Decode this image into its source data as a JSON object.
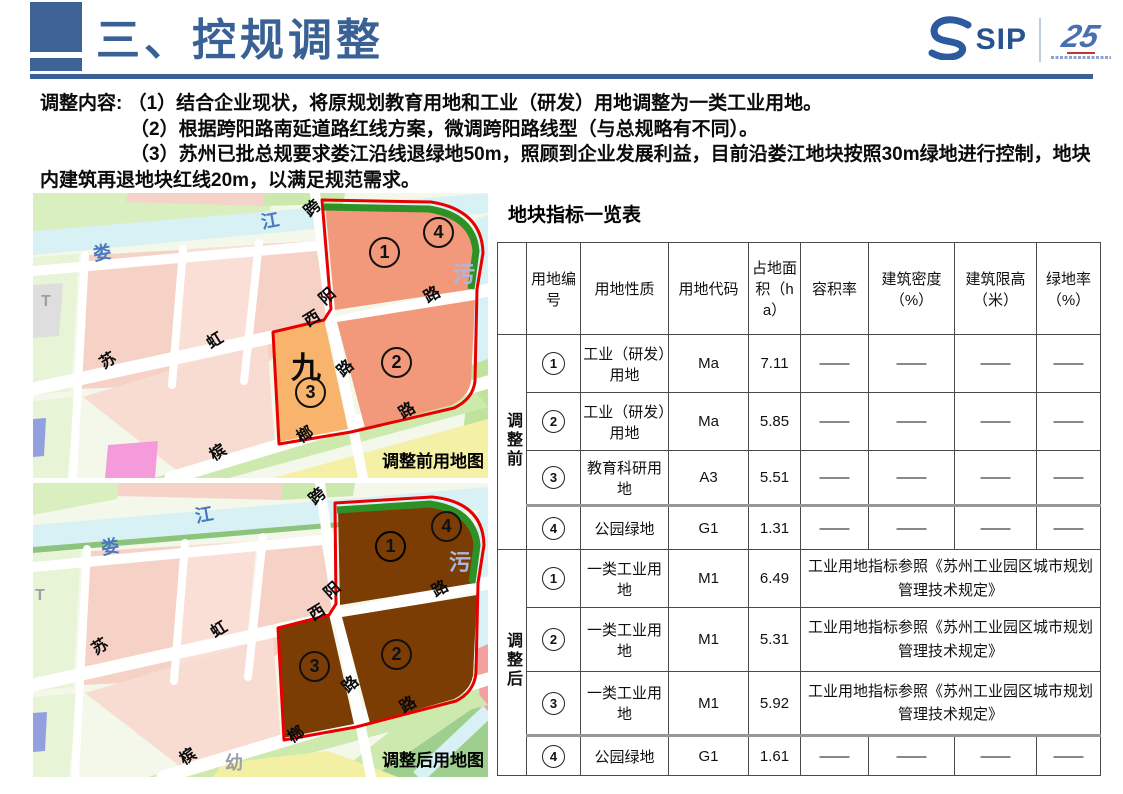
{
  "colors": {
    "accent_blue": "#3A6195",
    "table_red": "#C00000",
    "outline_red": "#E80000",
    "park_green": "#2E9125",
    "industry_rd_salmon": "#F2997B",
    "education_orange": "#F8B46C",
    "industry_m1_brown": "#7C3D05"
  },
  "header": {
    "title": "三、控规调整",
    "logo_sip": "SIP",
    "logo_anniversary": "25"
  },
  "intro": {
    "prefix": "调整内容:",
    "item1": "（1）结合企业现状，将原规划教育用地和工业（研发）用地调整为一类工业用地。",
    "item2_normal": "（2）根据跨阳路南延道路红线方案，",
    "item2_bold": "微调跨阳路线型（与总规略有不同）。",
    "item3": "（3）苏州已批总规要求娄江沿线退绿地50m，照顾到企业发展利益，目前沿娄江地块按照30m绿地进行控制，地块内建筑再退地块红线20m，以满足规范需求。"
  },
  "maps": {
    "before": {
      "caption": "调整前用地图",
      "river": [
        "娄",
        "江"
      ],
      "roads": [
        "跨",
        "阳",
        "路",
        "西",
        "虹",
        "苏",
        "路",
        "槟",
        "榔",
        "路"
      ],
      "water_label": "污",
      "transit_label": "T",
      "site_label": "九",
      "blocks": [
        "1",
        "2",
        "3",
        "4"
      ]
    },
    "after": {
      "caption": "调整后用地图",
      "river": [
        "娄",
        "江"
      ],
      "roads": [
        "跨",
        "阳",
        "路",
        "西",
        "虹",
        "苏",
        "路",
        "槟",
        "榔",
        "路"
      ],
      "water_label": "污",
      "transit_label": "T",
      "kindergarten_label": "幼",
      "blocks": [
        "1",
        "2",
        "3",
        "4"
      ]
    }
  },
  "table": {
    "title": "地块指标一览表",
    "headers": [
      "",
      "用地编号",
      "用地性质",
      "用地代码",
      "占地面积（ha）",
      "容积率",
      "建筑密度（%）",
      "建筑限高（米）",
      "绿地率（%）"
    ],
    "sections": [
      {
        "label": "调整前",
        "rows": [
          {
            "no": "1",
            "nature": "工业（研发）用地",
            "code": "Ma",
            "area": "7.11",
            "far": "——",
            "density": "——",
            "limit": "——",
            "green": "——"
          },
          {
            "no": "2",
            "nature": "工业（研发）用地",
            "code": "Ma",
            "area": "5.85",
            "far": "——",
            "density": "——",
            "limit": "——",
            "green": "——"
          },
          {
            "no": "3",
            "nature": "教育科研用地",
            "code": "A3",
            "area": "5.51",
            "far": "——",
            "density": "——",
            "limit": "——",
            "green": "——"
          },
          {
            "no": "4",
            "nature": "公园绿地",
            "code": "G1",
            "area": "1.31",
            "far": "——",
            "density": "——",
            "limit": "——",
            "green": "——"
          }
        ]
      },
      {
        "label": "调整后",
        "rows": [
          {
            "no": "1",
            "nature": "一类工业用地",
            "code": "M1",
            "area": "6.49",
            "note": "工业用地指标参照《苏州工业园区城市规划管理技术规定》"
          },
          {
            "no": "2",
            "nature": "一类工业用地",
            "code": "M1",
            "area": "5.31",
            "note": "工业用地指标参照《苏州工业园区城市规划管理技术规定》"
          },
          {
            "no": "3",
            "nature": "一类工业用地",
            "code": "M1",
            "area": "5.92",
            "note": "工业用地指标参照《苏州工业园区城市规划管理技术规定》"
          },
          {
            "no": "4",
            "nature": "公园绿地",
            "code": "G1",
            "area": "1.61",
            "far": "——",
            "density": "——",
            "limit": "——",
            "green": "——"
          }
        ]
      }
    ]
  }
}
